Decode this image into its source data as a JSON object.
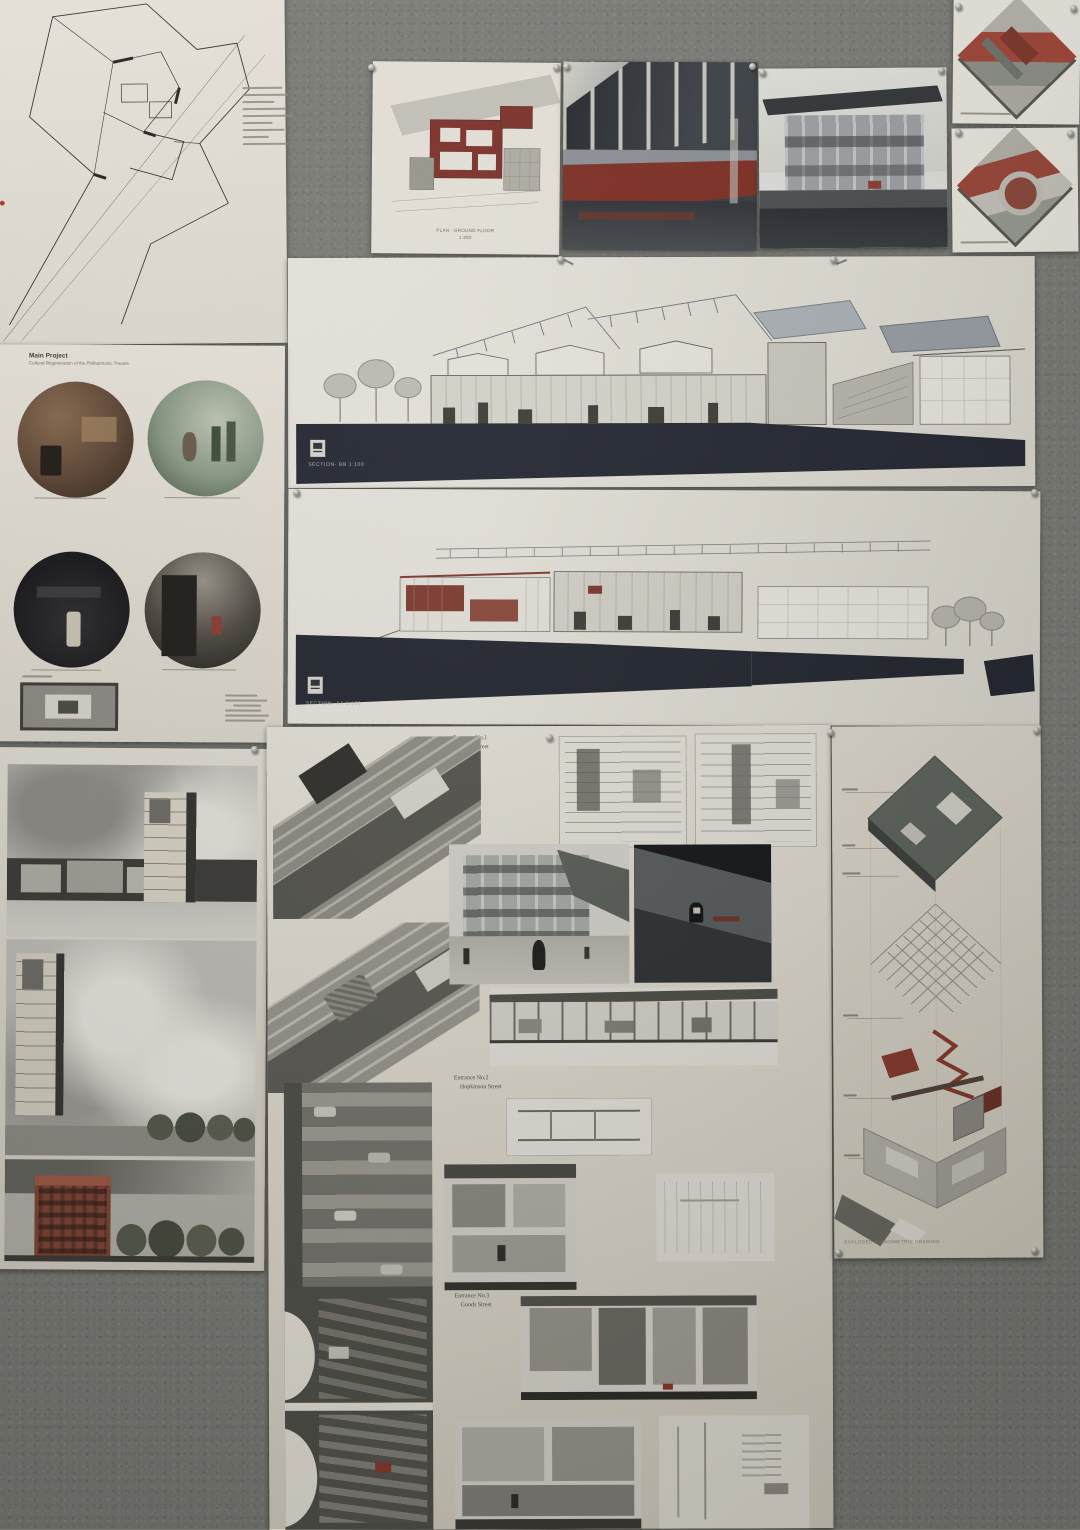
{
  "scene_colors": {
    "wall": "#7b7c76",
    "paper": "#eae6dc",
    "paper_dim": "#ddd8cc",
    "ground_dark": "#212530",
    "brick_red": "#8c3a2c",
    "floor_red": "#7e2b20",
    "model_red": "#a04334"
  },
  "labels": {
    "main_project": {
      "title": "Main Project",
      "subtitle": "Cultural Regeneration of the Philharmonic Theatre"
    },
    "plan_sheet": {
      "caption1": "PLAN : GROUND FLOOR",
      "caption2": "1:250"
    },
    "section_bb": {
      "label": "SECTION- BB  1:100"
    },
    "section_aa": {
      "label": "SECTION- AA  1:100"
    },
    "entrances": [
      {
        "line1": "Entrance No.1",
        "line2": "Irving Street"
      },
      {
        "line1": "Entrance No.2",
        "line2": "Hopkinson Street"
      },
      {
        "line1": "Entrance No.3",
        "line2": "Goods Street"
      }
    ],
    "axon_poster": {
      "caption": "EXPLODED AXONOMETRIC DRAWING"
    }
  }
}
